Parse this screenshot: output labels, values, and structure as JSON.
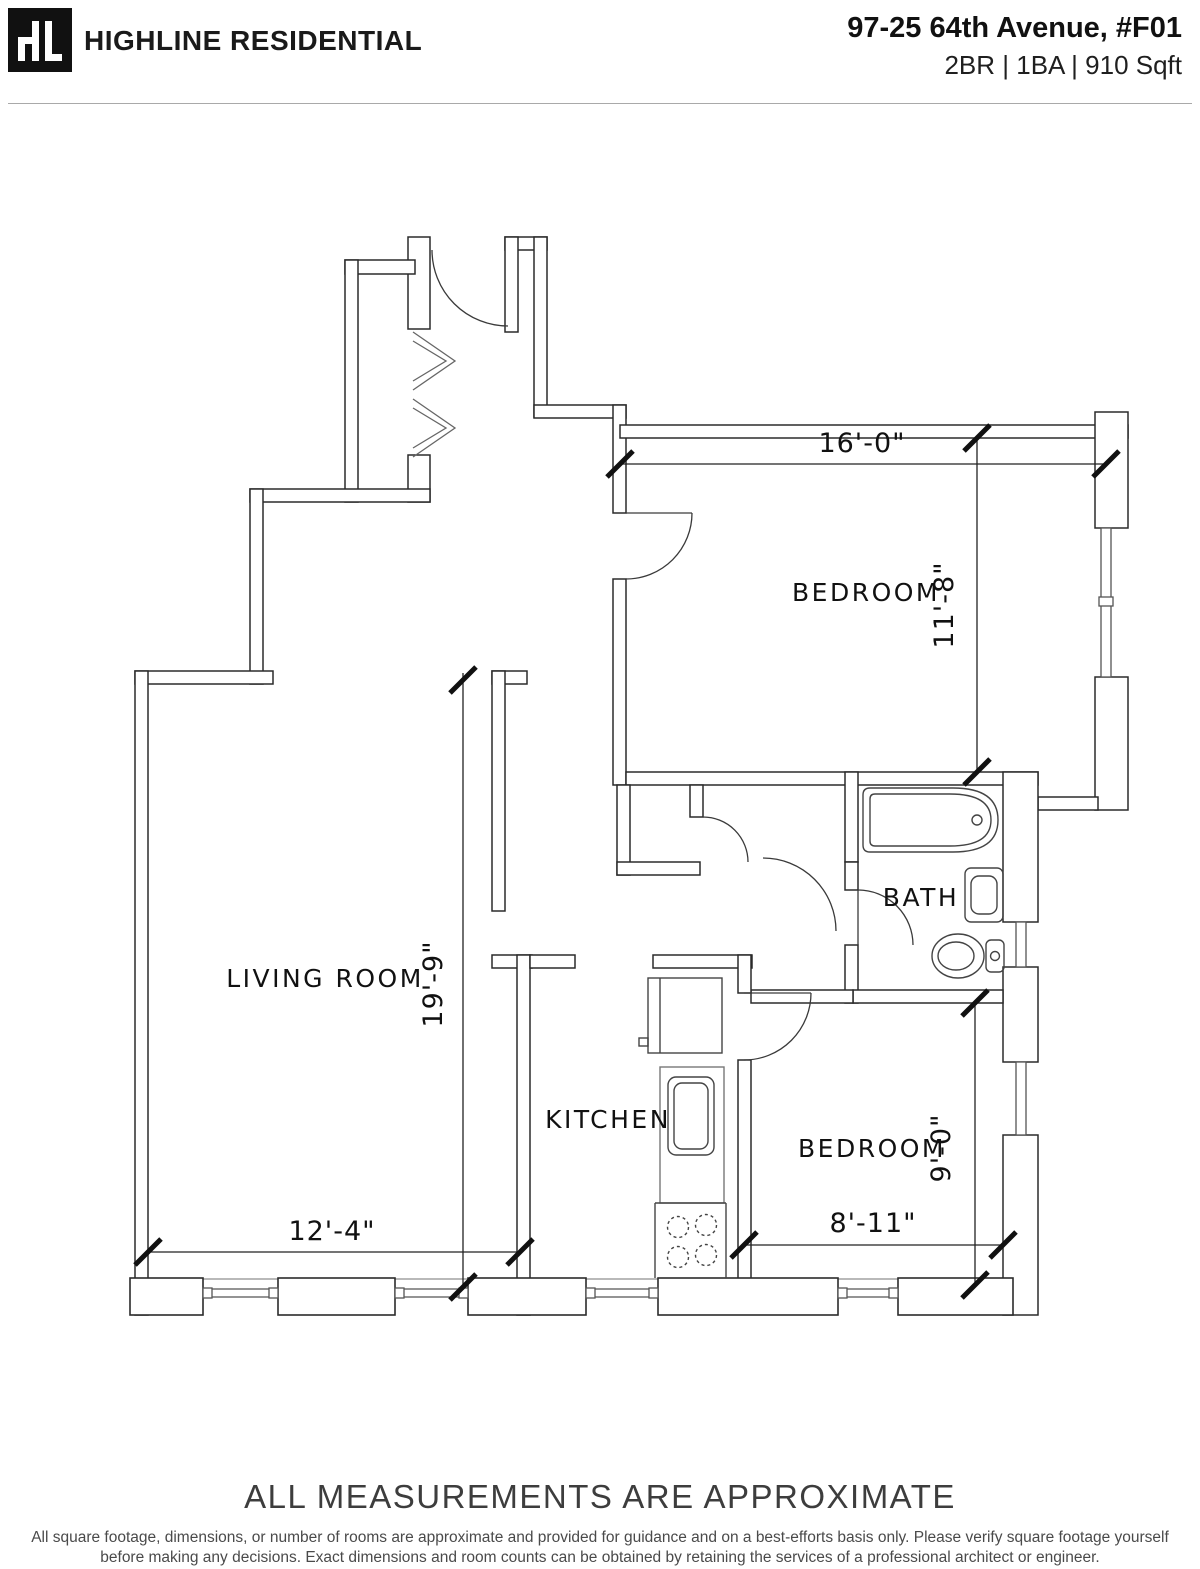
{
  "header": {
    "logo_monogram": "HL",
    "brand": "HIGHLINE RESIDENTIAL",
    "address": "97-25 64th Avenue, #F01",
    "specs": "2BR | 1BA | 910 Sqft"
  },
  "plan": {
    "labels": {
      "bedroom_1": "BEDROOM",
      "bath": "BATH",
      "living_room": "LIVING ROOM",
      "kitchen": "KITCHEN",
      "bedroom_2": "BEDROOM"
    },
    "dims": {
      "bedroom1_width": "16'-0\"",
      "bedroom1_depth": "11'-8\"",
      "living_room_length": "19'-9\"",
      "living_room_width": "12'-4\"",
      "bedroom2_width": "8'-11\"",
      "bedroom2_depth": "9'-0\""
    },
    "colors": {
      "ink": "#2b2b2b",
      "light_line": "#8f8f8f",
      "logo_bg": "#111111"
    }
  },
  "footer": {
    "notice": "ALL MEASUREMENTS ARE APPROXIMATE",
    "disclaimer": "All square footage, dimensions, or number of rooms are approximate and provided for guidance and on a best-efforts basis only. Please verify square footage yourself before making any decisions. Exact dimensions and room counts can be obtained by retaining the services of a professional architect or engineer."
  }
}
